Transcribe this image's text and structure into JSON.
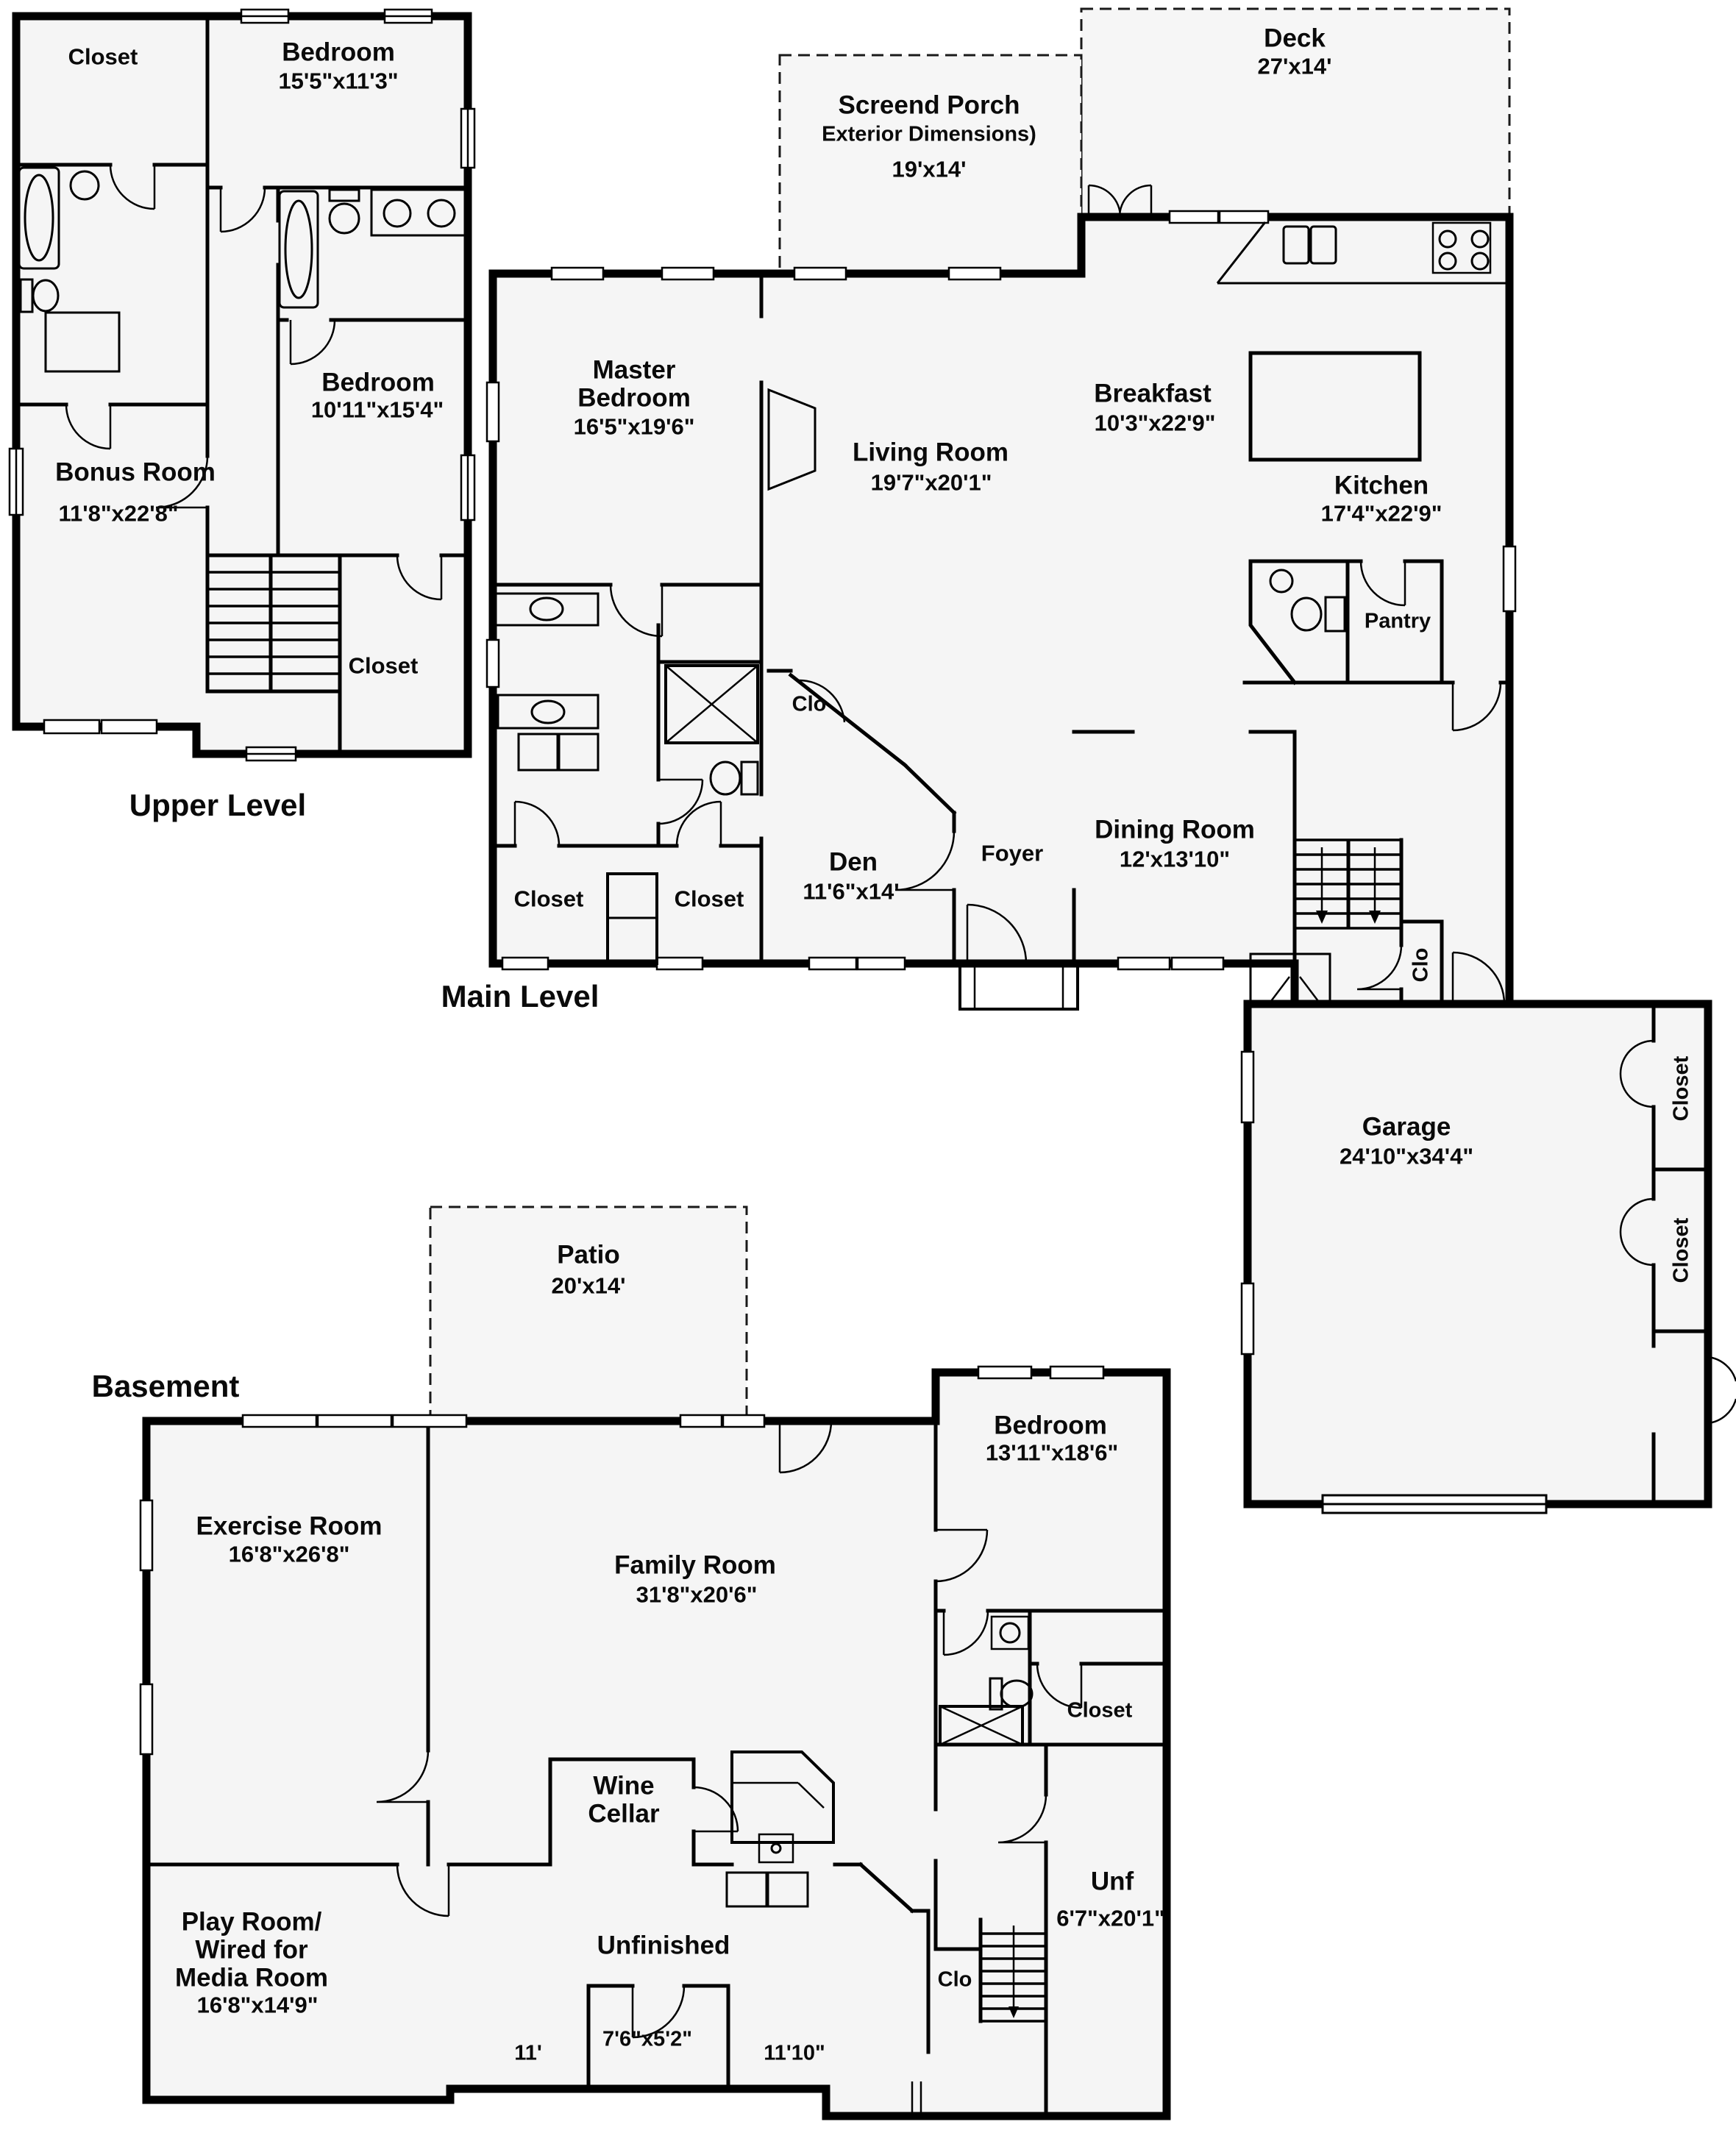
{
  "levels": {
    "upper": "Upper Level",
    "main": "Main Level",
    "basement": "Basement"
  },
  "outdoor": {
    "screened_porch": {
      "name": "Screend Porch",
      "note": "Exterior Dimensions)",
      "dims": "19'x14'"
    },
    "deck": {
      "name": "Deck",
      "dims": "27'x14'"
    },
    "patio": {
      "name": "Patio",
      "dims": "20'x14'"
    }
  },
  "upper": {
    "closet1": {
      "name": "Closet"
    },
    "bedroom1": {
      "name": "Bedroom",
      "dims": "15'5\"x11'3\""
    },
    "bedroom2": {
      "name": "Bedroom",
      "dims": "10'11\"x15'4\""
    },
    "bonus": {
      "name": "Bonus Room",
      "dims": "11'8\"x22'8\""
    },
    "closet2": {
      "name": "Closet"
    }
  },
  "main": {
    "master": {
      "name1": "Master",
      "name2": "Bedroom",
      "dims": "16'5\"x19'6\""
    },
    "living": {
      "name": "Living Room",
      "dims": "19'7\"x20'1\""
    },
    "breakfast": {
      "name": "Breakfast",
      "dims": "10'3\"x22'9\""
    },
    "kitchen": {
      "name": "Kitchen",
      "dims": "17'4\"x22'9\""
    },
    "pantry": {
      "name": "Pantry"
    },
    "den": {
      "name": "Den",
      "dims": "11'6\"x14'"
    },
    "foyer": {
      "name": "Foyer"
    },
    "dining": {
      "name": "Dining Room",
      "dims": "12'x13'10\""
    },
    "clo_den": {
      "name": "Clo"
    },
    "clo_stairs": {
      "name": "Clo"
    },
    "closet_left": {
      "name": "Closet"
    },
    "closet_right": {
      "name": "Closet"
    },
    "garage": {
      "name": "Garage",
      "dims": "24'10\"x34'4\""
    },
    "garage_closet1": {
      "name": "Closet"
    },
    "garage_closet2": {
      "name": "Closet"
    }
  },
  "basement": {
    "exercise": {
      "name": "Exercise Room",
      "dims": "16'8\"x26'8\""
    },
    "family": {
      "name": "Family Room",
      "dims": "31'8\"x20'6\""
    },
    "bedroom": {
      "name": "Bedroom",
      "dims": "13'11\"x18'6\""
    },
    "closet": {
      "name": "Closet"
    },
    "wine": {
      "name1": "Wine",
      "name2": "Cellar"
    },
    "unfinished": {
      "name": "Unfinished"
    },
    "playroom": {
      "line1": "Play Room/",
      "line2": "Wired for",
      "line3": "Media Room",
      "dims": "16'8\"x14'9\""
    },
    "unf": {
      "name": "Unf",
      "dims": "6'7\"x20'1\""
    },
    "clo": {
      "name": "Clo"
    },
    "dim_11": "11'",
    "dim_76": "7'6\"x5'2\"",
    "dim_1110": "11'10\""
  }
}
